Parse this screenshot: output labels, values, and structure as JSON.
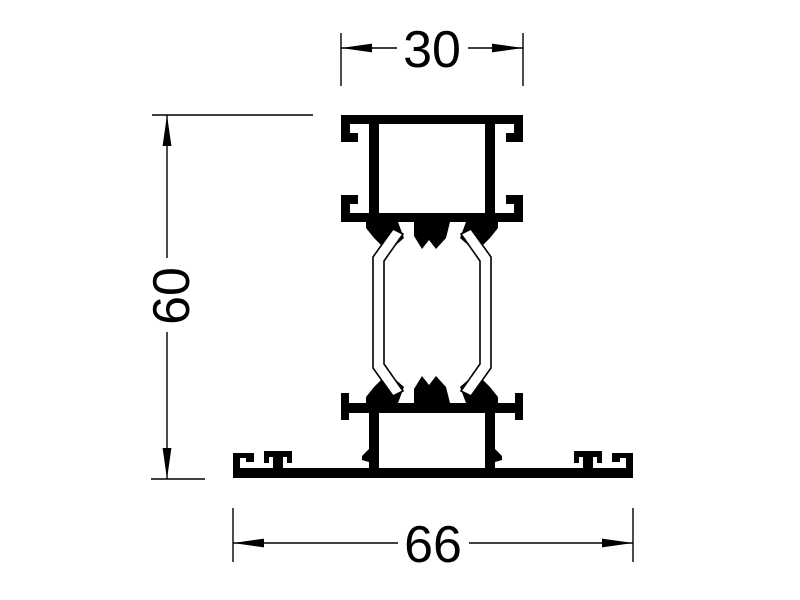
{
  "drawing": {
    "background_color": "#ffffff",
    "line_color": "#000000"
  },
  "dimensions": {
    "top_width": {
      "label": "30"
    },
    "height": {
      "label": "60"
    },
    "bottom_width": {
      "label": "66"
    }
  }
}
